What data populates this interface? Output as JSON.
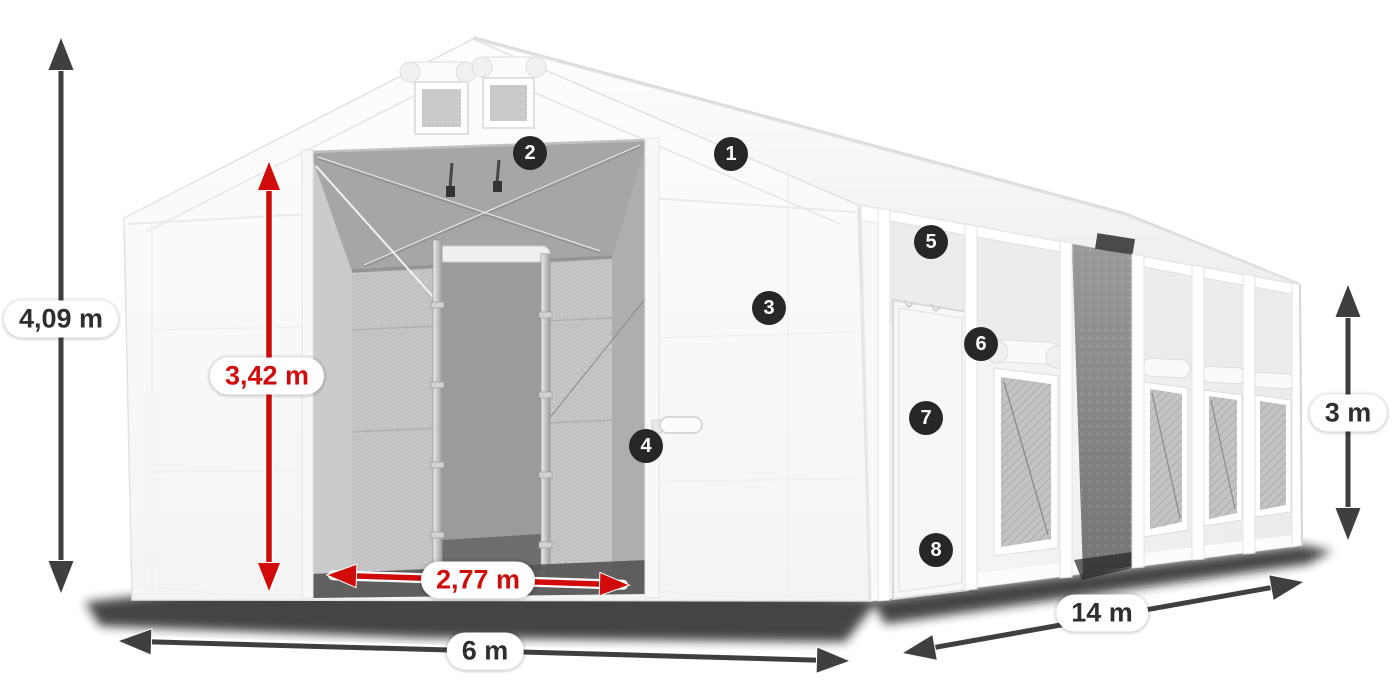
{
  "title": "Storage tent dimensional diagram",
  "callouts": [
    "1",
    "2",
    "3",
    "4",
    "5",
    "6",
    "7",
    "8"
  ],
  "dimensions": {
    "total_height": "4,09 m",
    "entrance_height": "3,42 m",
    "entrance_width": "2,77 m",
    "front_width": "6 m",
    "side_length": "14 m",
    "side_wall_height": "3 m"
  },
  "colors": {
    "canvas_bg": "#ffffff",
    "accent_red": "#d10a0a",
    "arrow_dark": "#3f3f3f",
    "badge_bg": "#272727",
    "pill_text": "#2e2e2e",
    "pill_bg": "#ffffff"
  }
}
